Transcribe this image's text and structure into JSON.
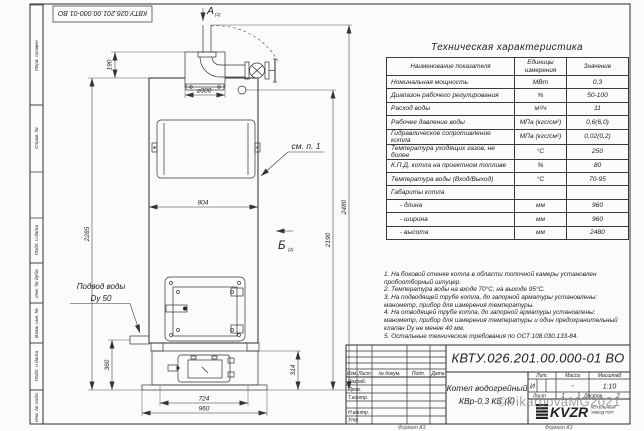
{
  "frame": {
    "stamp_top": "КВТУ.026.201.00.000-01 ВО",
    "side_labels": [
      "Перв. примен.",
      "Справ. №",
      "Подп. и дата",
      "Инв. № дубл.",
      "Взам. инв. №",
      "Подп. и дата",
      "Инв. № подл."
    ],
    "format_label": "Формат А3"
  },
  "drawing": {
    "view_a": "А",
    "view_a_ref": "(2)",
    "view_b": "Б",
    "view_b_ref": "(2)",
    "callout_see_item": "см. п. 1",
    "water_inlet_line1": "Подвод воды",
    "water_inlet_line2": "Dy 50",
    "dims": {
      "d190": "190",
      "d300": "⌀300",
      "d2285": "2285",
      "d804": "804",
      "d360": "360",
      "d724": "724",
      "d960": "960",
      "d314": "314",
      "d2190": "2190",
      "d2480": "2480"
    }
  },
  "tech_table": {
    "title": "Техническая характеристика",
    "headers": [
      "Наименование показателя",
      "Единицы измерения",
      "Значение"
    ],
    "rows": [
      {
        "name": "Номинальная мощность",
        "unit": "МВт",
        "value": "0,3"
      },
      {
        "name": "Диапазон рабочего регулирования",
        "unit": "%",
        "value": "50-100"
      },
      {
        "name": "Расход воды",
        "unit": "м³/ч",
        "value": "11"
      },
      {
        "name": "Рабочее давление воды",
        "unit": "МПа (кгс/см²)",
        "value": "0,6(6,0)"
      },
      {
        "name": "Гидравлическое сопротивление котла",
        "unit": "МПа (кгс/см²)",
        "value": "0,02(0,2)"
      },
      {
        "name": "Температура уходящих газов, не более",
        "unit": "°С",
        "value": "250"
      },
      {
        "name": "К.П.Д. котла на проектном топливе",
        "unit": "%",
        "value": "80"
      },
      {
        "name": "Температура воды (Вход/Выход)",
        "unit": "°С",
        "value": "70-95"
      },
      {
        "name": "Габариты котла",
        "unit": "",
        "value": ""
      },
      {
        "name": "- длина",
        "unit": "мм",
        "value": "960"
      },
      {
        "name": "- ширина",
        "unit": "мм",
        "value": "960"
      },
      {
        "name": "- высота",
        "unit": "мм",
        "value": "2480"
      }
    ]
  },
  "notes": [
    "1. На боковой стенке котла в области топочной камеры установлен пробоотборный штуцер.",
    "2. Температура воды на входе 70°С, на выходе 95°С.",
    "3. На подводящей трубе котла, до запорной арматуры установлены: манометр, прибор для измерения температуры.",
    "4. На отводящей трубе котла, до запорной арматуры установлены: манометр, прибор для измерения температуры и один предохранительный клапан Dу не менее 40 мм.",
    "5. Остальные технические требования по ОСТ 108.030.133-84."
  ],
  "title_block": {
    "designation": "КВТУ.026.201.00.000-01 ВО",
    "product_line1": "Котел водогрейный",
    "product_line2": "КВр-0,3 КБ (К)",
    "labels": {
      "izm": "Изм",
      "list": "Лист",
      "doc": "№ докум.",
      "podp": "Подп.",
      "data": "Дата",
      "razrab": "Разраб.",
      "prov": "Пров.",
      "tkontr": "Т.контр.",
      "nkontr": "Н.контр.",
      "utv": "Утв.",
      "lit": "Лит.",
      "massa": "Масса",
      "masshtab": "Масштаб",
      "sheet": "Лист",
      "sheets": "Листов"
    },
    "lit_value": "И",
    "massa_value": "-",
    "scale_value": "1:10",
    "sheet_value": "1",
    "sheets_value": "2",
    "logo_text": "KVZR",
    "logo_sub1": "КОТЕЛЬНЫЙ",
    "logo_sub2": "ЗАВОД РЭП",
    "watermark": "©PikarpovaMG2021"
  }
}
